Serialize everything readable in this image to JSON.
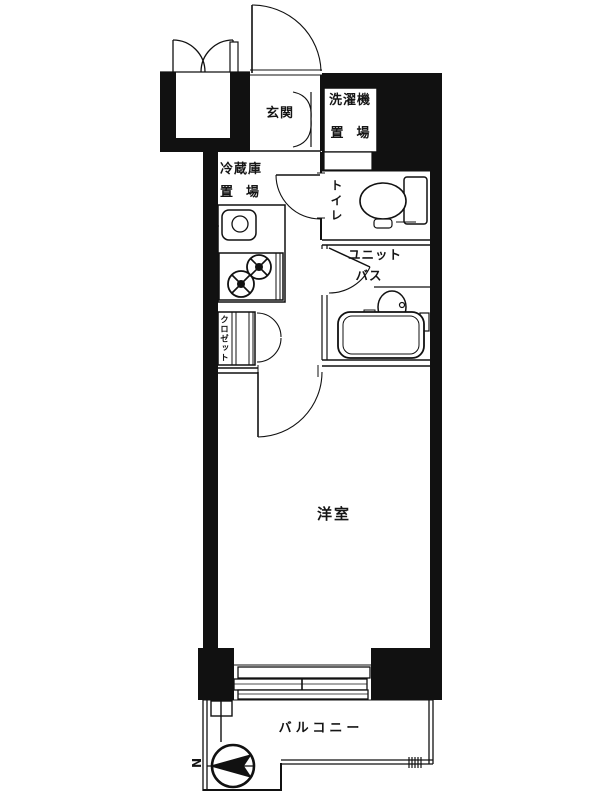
{
  "title": "1K apartment floor plan",
  "rooms": {
    "genkan": "玄関",
    "washer_line1": "洗濯機",
    "washer_line2": "置　場",
    "fridge_line1": "冷蔵庫",
    "fridge_line2": "置　場",
    "toilet": "トイレ",
    "unit_bath_line1": "ユニット",
    "unit_bath_line2": "バス",
    "closet": "クロゼット",
    "western_room": "洋室",
    "balcony": "バルコニー"
  },
  "compass": {
    "north_label": "N"
  },
  "colors": {
    "wall": "#111111",
    "background": "#ffffff"
  }
}
